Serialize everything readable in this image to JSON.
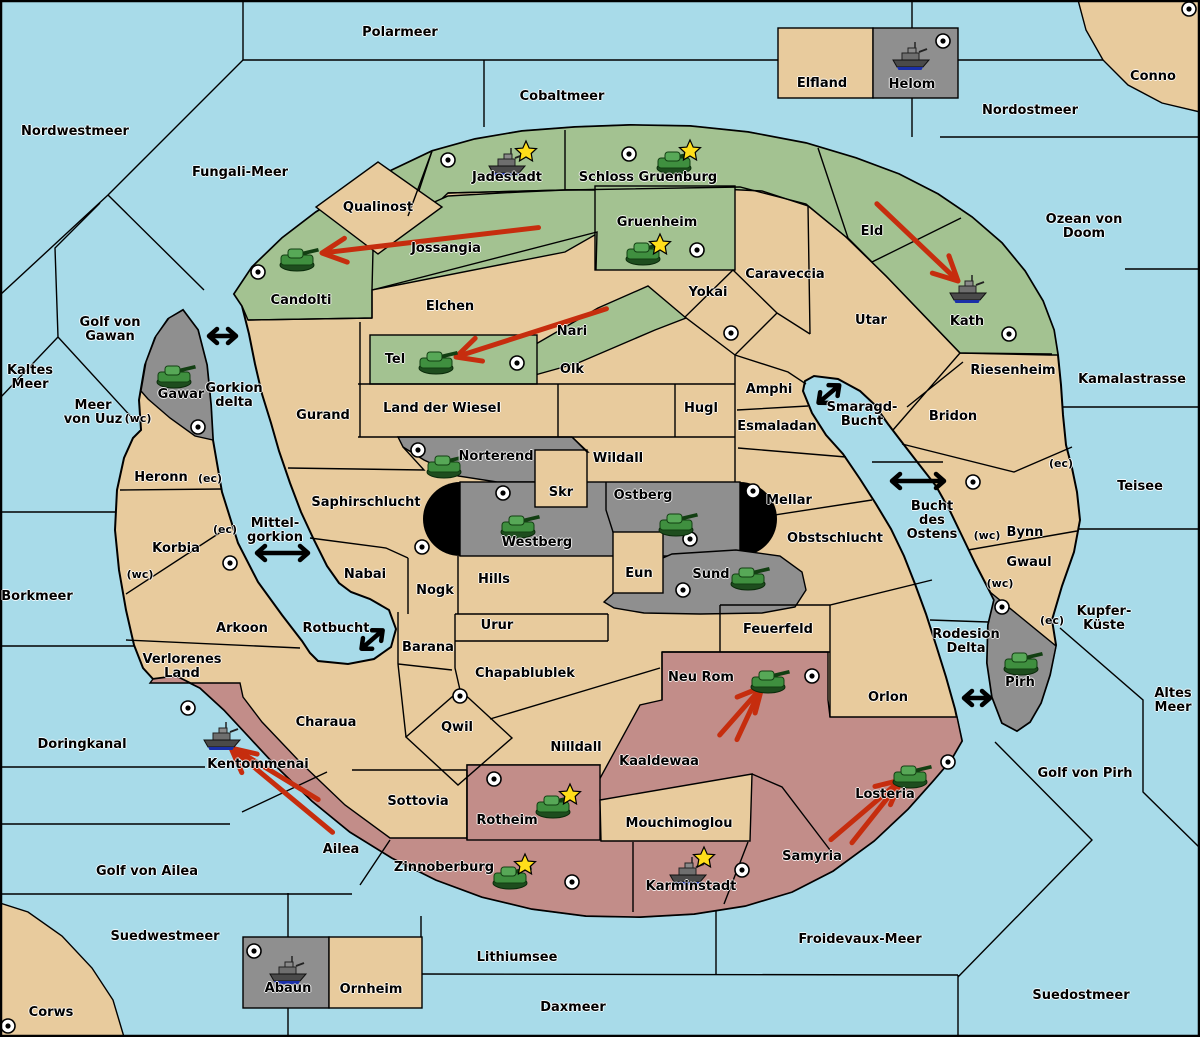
{
  "colors": {
    "sea": "#A8DBE9",
    "land": "#E8CB9D",
    "green": "#A3C291",
    "red": "#C28D89",
    "gray": "#8F8F8F",
    "arrow": "#C62D0E",
    "star": "#FFDE1A",
    "ink": "#000000"
  },
  "marks": {
    "wc": "(wc)",
    "ec": "(ec)"
  },
  "seas": {
    "polarmeer": "Polarmeer",
    "cobaltmeer": "Cobaltmeer",
    "nordostmeer": "Nordostmeer",
    "nordwestmeer": "Nordwestmeer",
    "fungali": "Fungali-Meer",
    "ozean_von_doom": "Ozean von Doom",
    "kamalastrasse": "Kamalastrasse",
    "teisee": "Teisee",
    "kupfer_kueste": "Kupfer-\nKüste",
    "altes_meer": "Altes\nMeer",
    "golf_von_pirh": "Golf von Pirh",
    "suedostmeer": "Suedostmeer",
    "froidevaux": "Froidevaux-Meer",
    "daxmeer": "Daxmeer",
    "lithiumsee": "Lithiumsee",
    "suedwestmeer": "Suedwestmeer",
    "golf_von_ailea": "Golf von Ailea",
    "doringkanal": "Doringkanal",
    "borkmeer": "Borkmeer",
    "meer_von_uuz": "Meer\nvon Uuz",
    "kaltes_meer": "Kaltes\nMeer",
    "golf_von_gawan": "Golf von\nGawan",
    "gorkion_delta": "Gorkion\ndelta",
    "mittelgorkion": "Mittel-\ngorkion",
    "rotbucht": "Rotbucht",
    "smaragd_bucht": "Smaragd-\nBucht",
    "bucht_des_ostens": "Bucht\ndes\nOstens",
    "rodesion_delta": "Rodesion\nDelta"
  },
  "territories": {
    "jadestadt": "Jadestadt",
    "schloss_gruenburg": "Schloss Gruenburg",
    "gruenheim": "Gruenheim",
    "qualinost": "Qualinost",
    "jossangia": "Jossangia",
    "candolti": "Candolti",
    "elchen": "Elchen",
    "nari": "Nari",
    "tel": "Tel",
    "olk": "Olk",
    "land_der_wiesel": "Land der Wiesel",
    "gurand": "Gurand",
    "eld": "Eld",
    "kath": "Kath",
    "utar": "Utar",
    "caraveccia": "Caraveccia",
    "yokai": "Yokai",
    "amphi": "Amphi",
    "esmaladan": "Esmaladan",
    "hugl": "Hugl",
    "riesenheim": "Riesenheim",
    "bridon": "Bridon",
    "bynn": "Bynn",
    "gwaul": "Gwaul",
    "pirh": "Pirh",
    "mellar": "Mellar",
    "obstschlucht": "Obstschlucht",
    "wildall": "Wildall",
    "skr": "Skr",
    "ostberg": "Ostberg",
    "westberg": "Westberg",
    "eun": "Eun",
    "sund": "Sund",
    "norterend": "Norterend",
    "saphirschlucht": "Saphirschlucht",
    "nabai": "Nabai",
    "nogk": "Nogk",
    "hills": "Hills",
    "urur": "Urur",
    "barana": "Barana",
    "arkoon": "Arkoon",
    "verlorenes_land": "Verlorenes\nLand",
    "heronn": "Heronn",
    "korbia": "Korbia",
    "gawar": "Gawar",
    "chapablublek": "Chapablublek",
    "qwil": "Qwil",
    "nilldall": "Nilldall",
    "charaua": "Charaua",
    "sottovia": "Sottovia",
    "kentommenai": "Kentommenai",
    "ailea": "Ailea",
    "zinnoberburg": "Zinnoberburg",
    "rotheim": "Rotheim",
    "karminstadt": "Karminstadt",
    "mouchimoglou": "Mouchimoglou",
    "kaaldewaa": "Kaaldewaa",
    "neu_rom": "Neu Rom",
    "feuerfeld": "Feuerfeld",
    "orlon": "Orlon",
    "samyria": "Samyria",
    "losteria": "Losteria",
    "elfland": "Elfland",
    "helom": "Helom",
    "abaun": "Abaun",
    "ornheim": "Ornheim",
    "conno": "Conno",
    "corws": "Corws"
  },
  "icons": {
    "tank": "green-tank-unit",
    "ship": "gray-warship-unit",
    "star": "yellow-star-badge",
    "city": "white-circle-city-marker",
    "attack": "red-attack-arrow",
    "link": "black-double-arrow-sea-link"
  },
  "units": [
    {
      "territory": "Jadestadt",
      "unit": "ship",
      "star": true
    },
    {
      "territory": "Schloss Gruenburg",
      "unit": "tank",
      "star": true
    },
    {
      "territory": "Gruenheim",
      "unit": "tank",
      "star": true
    },
    {
      "territory": "Candolti",
      "unit": "tank",
      "star": false
    },
    {
      "territory": "Tel",
      "unit": "tank",
      "star": false
    },
    {
      "territory": "Kath",
      "unit": "ship",
      "star": false
    },
    {
      "territory": "Gawar",
      "unit": "tank",
      "star": false
    },
    {
      "territory": "Helom",
      "unit": "ship",
      "star": false
    },
    {
      "territory": "Norterend",
      "unit": "tank",
      "star": false
    },
    {
      "territory": "Westberg",
      "unit": "tank",
      "star": false
    },
    {
      "territory": "Ostberg",
      "unit": "tank",
      "star": false
    },
    {
      "territory": "Sund",
      "unit": "tank",
      "star": false
    },
    {
      "territory": "Pirh",
      "unit": "tank",
      "star": false
    },
    {
      "territory": "Neu Rom",
      "unit": "tank",
      "star": false
    },
    {
      "territory": "Rotheim",
      "unit": "tank",
      "star": true
    },
    {
      "territory": "Zinnoberburg",
      "unit": "tank",
      "star": true
    },
    {
      "territory": "Karminstadt",
      "unit": "ship",
      "star": true
    },
    {
      "territory": "Kentommenai",
      "unit": "ship",
      "star": false
    },
    {
      "territory": "Losteria",
      "unit": "tank",
      "star": false
    },
    {
      "territory": "Abaun",
      "unit": "ship",
      "star": false
    }
  ],
  "city_markers": [
    "Jadestadt",
    "Schloss Gruenburg",
    "Gruenheim",
    "Candolti",
    "Tel",
    "Kath",
    "Gawar",
    "Helom",
    "Norterend",
    "Westberg",
    "Ostberg",
    "Sund",
    "Mellar",
    "Yokai",
    "Saphirschlucht",
    "Korbia",
    "Qwil",
    "Bynn",
    "Pirh",
    "Neu Rom",
    "Losteria",
    "Kentommenai",
    "Rotheim",
    "Zinnoberburg",
    "Karminstadt",
    "Abaun",
    "Conno",
    "Corws"
  ],
  "attack_arrows": [
    {
      "from": "Jossangia",
      "to": "Candolti"
    },
    {
      "from": "Nari",
      "to": "Tel"
    },
    {
      "from": "Eld",
      "to": "Kath"
    },
    {
      "from": "Ailea",
      "to": "Kentommenai"
    },
    {
      "from": "Kaaldewaa",
      "to": "Neu Rom"
    },
    {
      "from": "Samyria",
      "to": "Losteria"
    }
  ],
  "sea_links": [
    {
      "at": "Gorkion delta"
    },
    {
      "at": "Mittelgorkion"
    },
    {
      "at": "Rotbucht"
    },
    {
      "at": "Smaragd-Bucht"
    },
    {
      "at": "Bucht des Ostens"
    },
    {
      "at": "Rodesion Delta (Orlon–Pirh)"
    }
  ],
  "factions": {
    "green_army": {
      "color": "#A3C291",
      "territories": [
        "Jadestadt",
        "Schloss Gruenburg",
        "Gruenheim",
        "Jossangia",
        "Candolti",
        "Nari",
        "Tel",
        "Eld",
        "Kath"
      ]
    },
    "red_army": {
      "color": "#C28D89",
      "territories": [
        "Kentommenai",
        "Ailea",
        "Zinnoberburg",
        "Rotheim",
        "Karminstadt",
        "Samyria",
        "Losteria",
        "Kaaldewaa",
        "Neu Rom"
      ]
    },
    "gray_army": {
      "color": "#8F8F8F",
      "territories": [
        "Gawar",
        "Norterend",
        "Westberg",
        "Ostberg",
        "Sund",
        "Pirh",
        "Helom",
        "Abaun"
      ]
    },
    "neutral": {
      "color": "#E8CB9D"
    }
  }
}
